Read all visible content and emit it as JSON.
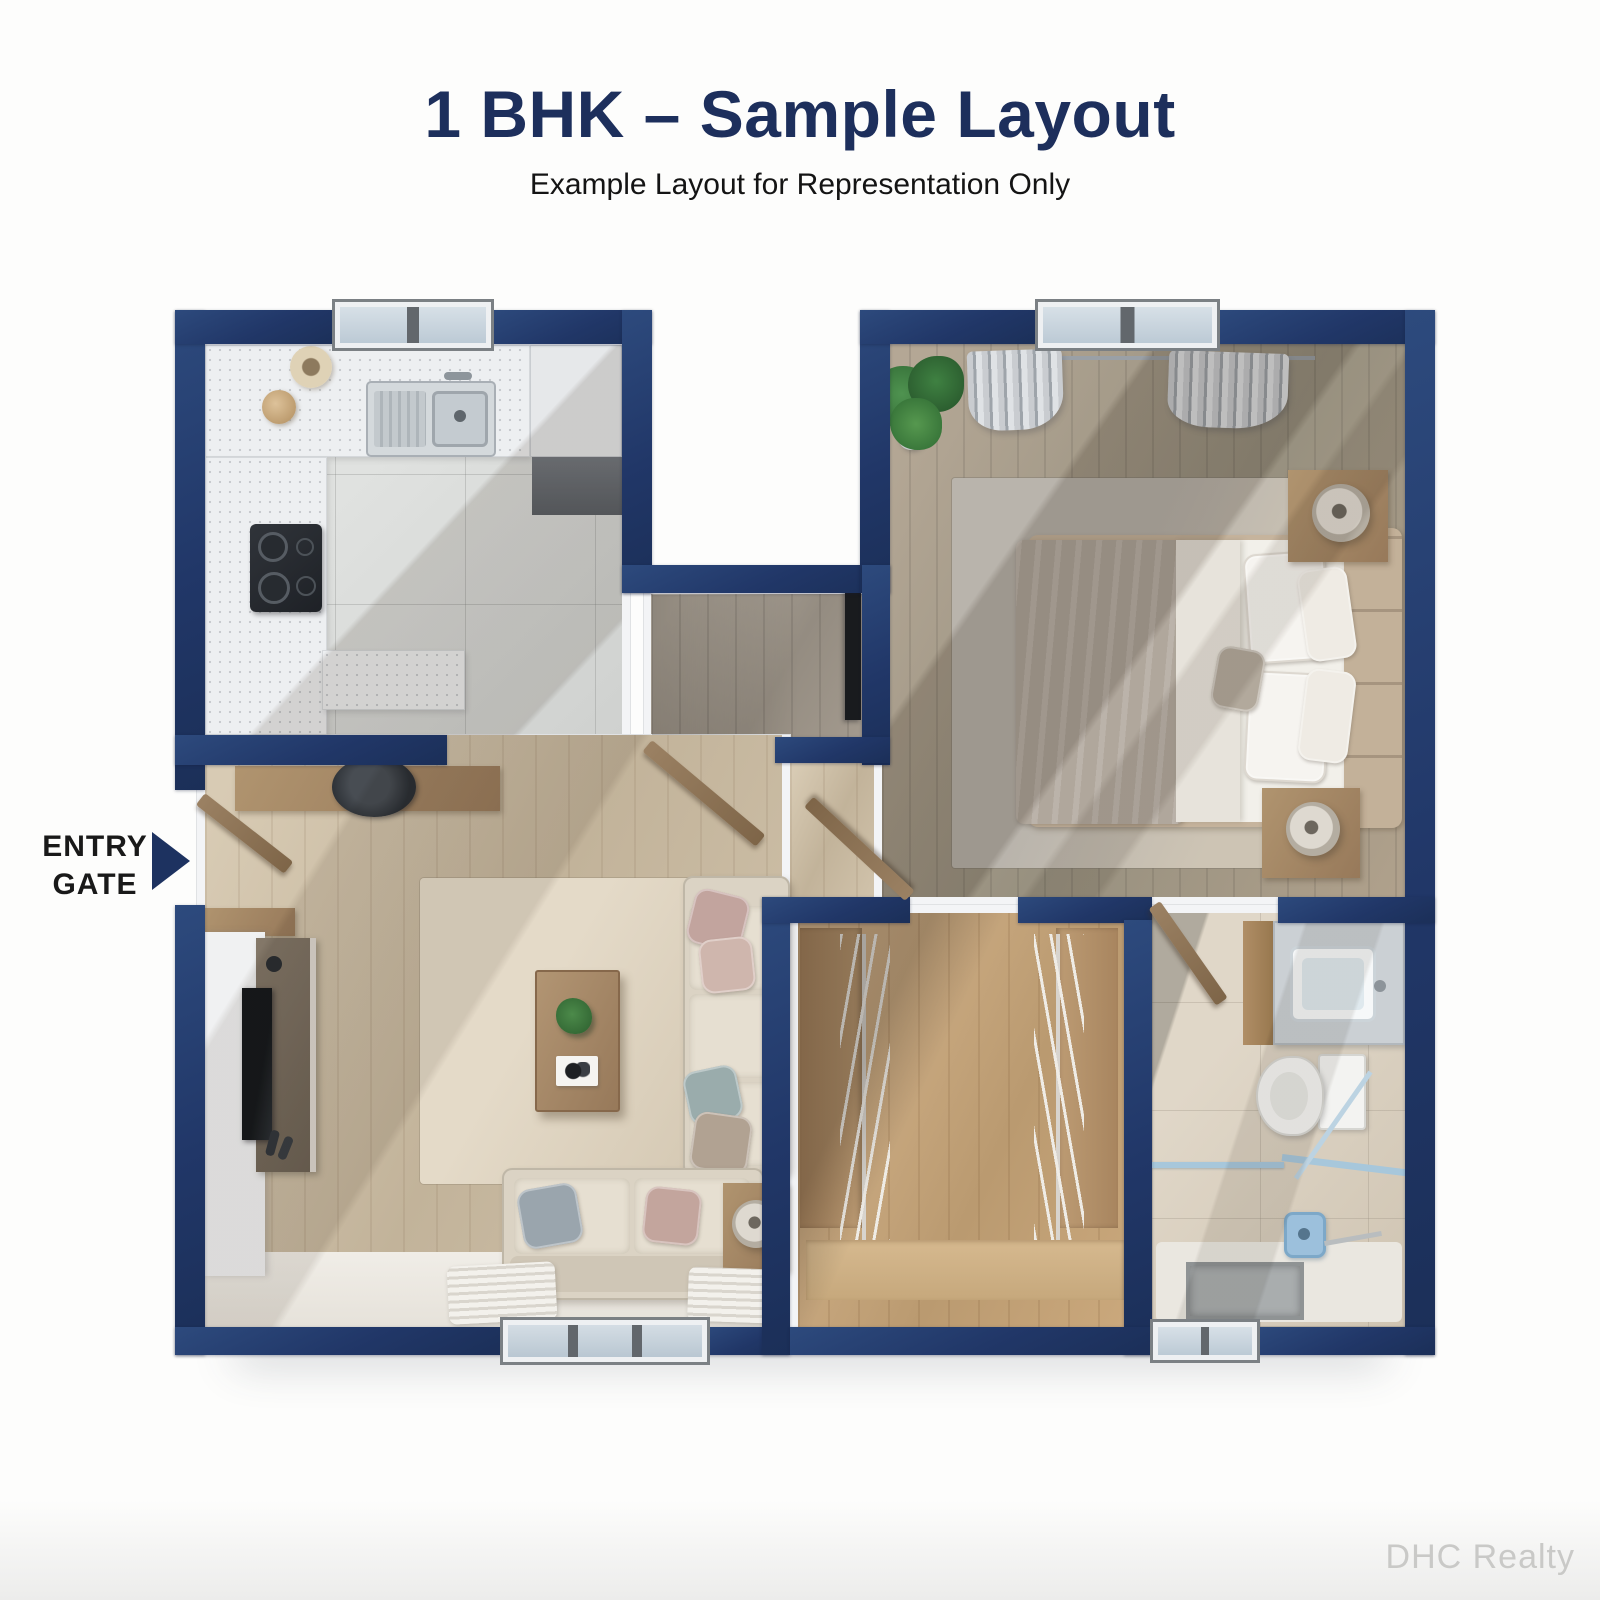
{
  "header": {
    "title": "1 BHK – Sample Layout",
    "subtitle": "Example Layout for Representation Only"
  },
  "entry_label": {
    "line1": "ENTRY",
    "line2": "GATE"
  },
  "watermark": "DHC Realty",
  "colors": {
    "wall_navy": "#213768",
    "title_navy": "#1d2f5c",
    "glass_blue": "#a7c7db",
    "floor_tile_gray": "#d9dbd9",
    "floor_wood_light": "#cfc1a9",
    "floor_wood_gray": "#a59c90",
    "floor_wood_warm": "#c9a87e",
    "floor_tile_beige": "#d9cfc0",
    "fabric_cream": "#dbd3c4",
    "furniture_wood": "#a2886a"
  }
}
